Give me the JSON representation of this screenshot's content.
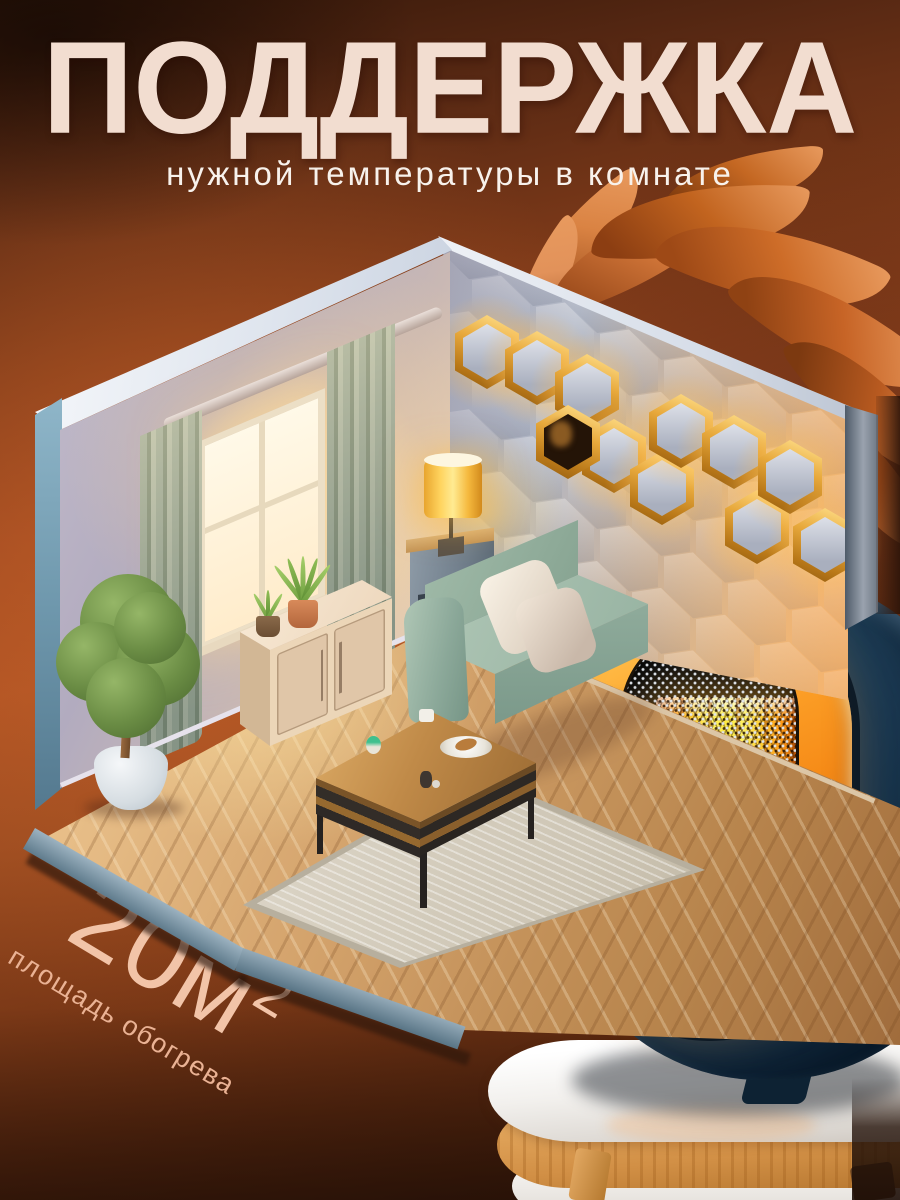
{
  "banner": {
    "headline": "ПОДДЕРЖКА",
    "subheadline": "нужной температуры в комнате",
    "area": {
      "value": "20м",
      "sup": "2",
      "caption": "площадь обогрева"
    }
  },
  "colors": {
    "background_mid": "#ab5123",
    "headline": "#f2ddd0",
    "subheadline": "#f8f2ec",
    "area_text": "#f2c4a8",
    "heater_body": "#1a3851",
    "heater_ring": "#ffa82e",
    "heater_glow": "#ffe93e",
    "wall": "#c3bccb",
    "accent_wall_gold": "#e8a93c",
    "sofa": "#9cb7a5",
    "floor": "#c89a68",
    "table_wood": "#d18f45"
  },
  "scene": {
    "room": {
      "description": "isometric cutaway living room with warm evening light",
      "elements": [
        "window with glowing daylight",
        "two sage curtains",
        "curtain rod",
        "cream tv cabinet with two doors",
        "grass plant in terracotta pot",
        "small plant in dark pot",
        "potted tree in white vase",
        "green sofa with two cream pillows",
        "wooden coffee table with plate and cups",
        "light rug",
        "side table with glowing yellow lamp",
        "honeycomb accent wall with gold lit cells",
        "rust-colored plant leaves behind wall"
      ]
    },
    "accent_wall": {
      "description": "hexagon 3d wall panel with gold-rimmed glowing sphere lights",
      "light_count": 10
    },
    "product": {
      "description": "portable heater, navy oval body, orange ring, honeycomb grille with glowing heating element, standing on round white table with wooden band and legs"
    }
  }
}
